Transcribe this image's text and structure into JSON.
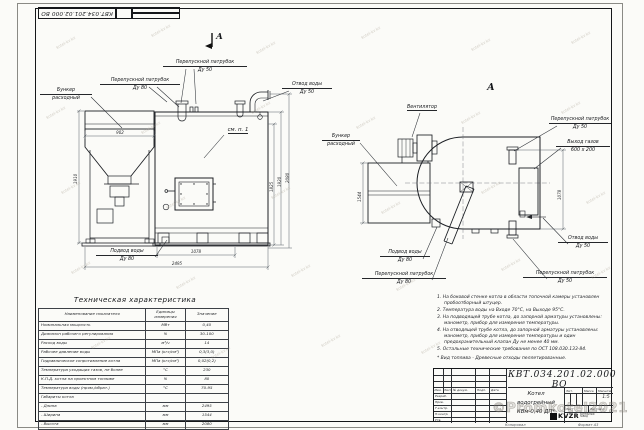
{
  "sheet": {
    "top_stamp": "КВТ.034.201.02.000 ВО",
    "footer_copy": "Копировал",
    "footer_format": "Формат А3",
    "watermark_tile": "kotel-kv.kz",
    "watermark_big": "©Promkotel2021"
  },
  "front_view": {
    "section_mark": "А",
    "labels": {
      "bypass50_l1": "Перепускной патрубок",
      "bypass50_l2": "Ду 50",
      "bypass80_l1": "Перепускной патрубок",
      "bypass80_l2": "Ду 80",
      "hopper_l1": "Бункер",
      "hopper_l2": "расходный",
      "water_out_l1": "Отвод воды",
      "water_out_l2": "Ду 50",
      "see_note": "см. п. 1",
      "water_in_l1": "Подвод воды",
      "water_in_l2": "Ду 80"
    },
    "dims": {
      "hopper_width": "902",
      "left_height": "1910",
      "base_length": "1078",
      "total_length": "2495",
      "h_mid": "1825",
      "h_upper": "1920",
      "h_total": "2080"
    }
  },
  "side_view": {
    "view_mark": "А",
    "labels": {
      "fan": "Вентилятор",
      "hopper_l1": "Бункер",
      "hopper_l2": "расходный",
      "bypass50_top_l1": "Перепускной патрубок",
      "bypass50_top_l2": "Ду 50",
      "gas_out_l1": "Выход газов",
      "gas_out_l2": "600 х 200",
      "water_out_l1": "Отвод воды",
      "water_out_l2": "Ду 50",
      "bypass50_bot_l1": "Перепускной патрубок",
      "bypass50_bot_l2": "Ду 50",
      "water_in_l1": "Подвод воды",
      "water_in_l2": "Ду 80",
      "bypass80_l1": "Перепускной патрубок",
      "bypass80_l2": "Ду 80"
    },
    "dims": {
      "depth": "1544",
      "gas_height": "1078"
    }
  },
  "spec_table": {
    "title": "Техническая характеристика",
    "headers": [
      "Наименование показателя",
      "Единицы измерения",
      "Значение"
    ],
    "rows": [
      [
        "Номинальная мощность",
        "МВт",
        "0,40"
      ],
      [
        "Диапазон рабочего регулирования",
        "%",
        "30-100"
      ],
      [
        "Расход воды",
        "м³/ч",
        "14"
      ],
      [
        "Рабочее давление воды",
        "МПа (кгс/см²)",
        "0,3(3,0)"
      ],
      [
        "Гидравлическое сопротивление котла",
        "МПа (кгс/см²)",
        "0,02(0,2)"
      ],
      [
        "Температура уходящих газов, не более",
        "°С",
        "230"
      ],
      [
        "К.П.Д. котла на проектном топливе",
        "%",
        "80"
      ],
      [
        "Температура воды (прям./обрат.)",
        "°С",
        "70-95"
      ],
      [
        "Габариты котла",
        "",
        ""
      ],
      [
        "    - Длина",
        "мм",
        "2495"
      ],
      [
        "    - Ширина",
        "мм",
        "1544"
      ],
      [
        "    - Высота",
        "мм",
        "2080"
      ]
    ]
  },
  "notes": {
    "items": [
      "1.  На боковой стенке котла в области топочной камеры установлен пробоотборный штуцер.",
      "2.  Температура воды на Входе 70°С, на Выходе 95°С.",
      "3.  На подводящей трубе котла, до запорной арматуры установлены: манометр, прибор для измерения температуры.",
      "4.  На отводящей трубе котла, до запорной арматуры установлены: манометр, прибор для измерения температуры и один предохранительный клапан Ду не менее 40 мм.",
      "5.  Остальные технические требования по ОСТ 108.030.133-84."
    ],
    "footnote": "*  Вид топлива - Древесные отходы пеллетированные."
  },
  "title_block": {
    "doc_number": "КВТ.034.201.02.000  ВО",
    "name_l1": "Котел водогрейный",
    "name_l2": "КВм-0,40  ДП*",
    "lit_label": "Лит.",
    "mass_label": "Масса",
    "scale_label": "Масштаб",
    "scale_value": "1:5",
    "sheet_label": "Лист",
    "sheets_label": "Листов 1",
    "sig_header": {
      "c1": "Изм.",
      "c2": "Лист",
      "c3": "№ докум.",
      "c4": "Подп.",
      "c5": "Дата"
    },
    "sig_rows": [
      "Разраб.",
      "Пров.",
      "Т.контр.",
      "Н.контр.",
      "Утв."
    ],
    "logo_text": "KVZR",
    "logo_sub": "КОТЕЛЬНЫЙ ЗАВОД"
  }
}
